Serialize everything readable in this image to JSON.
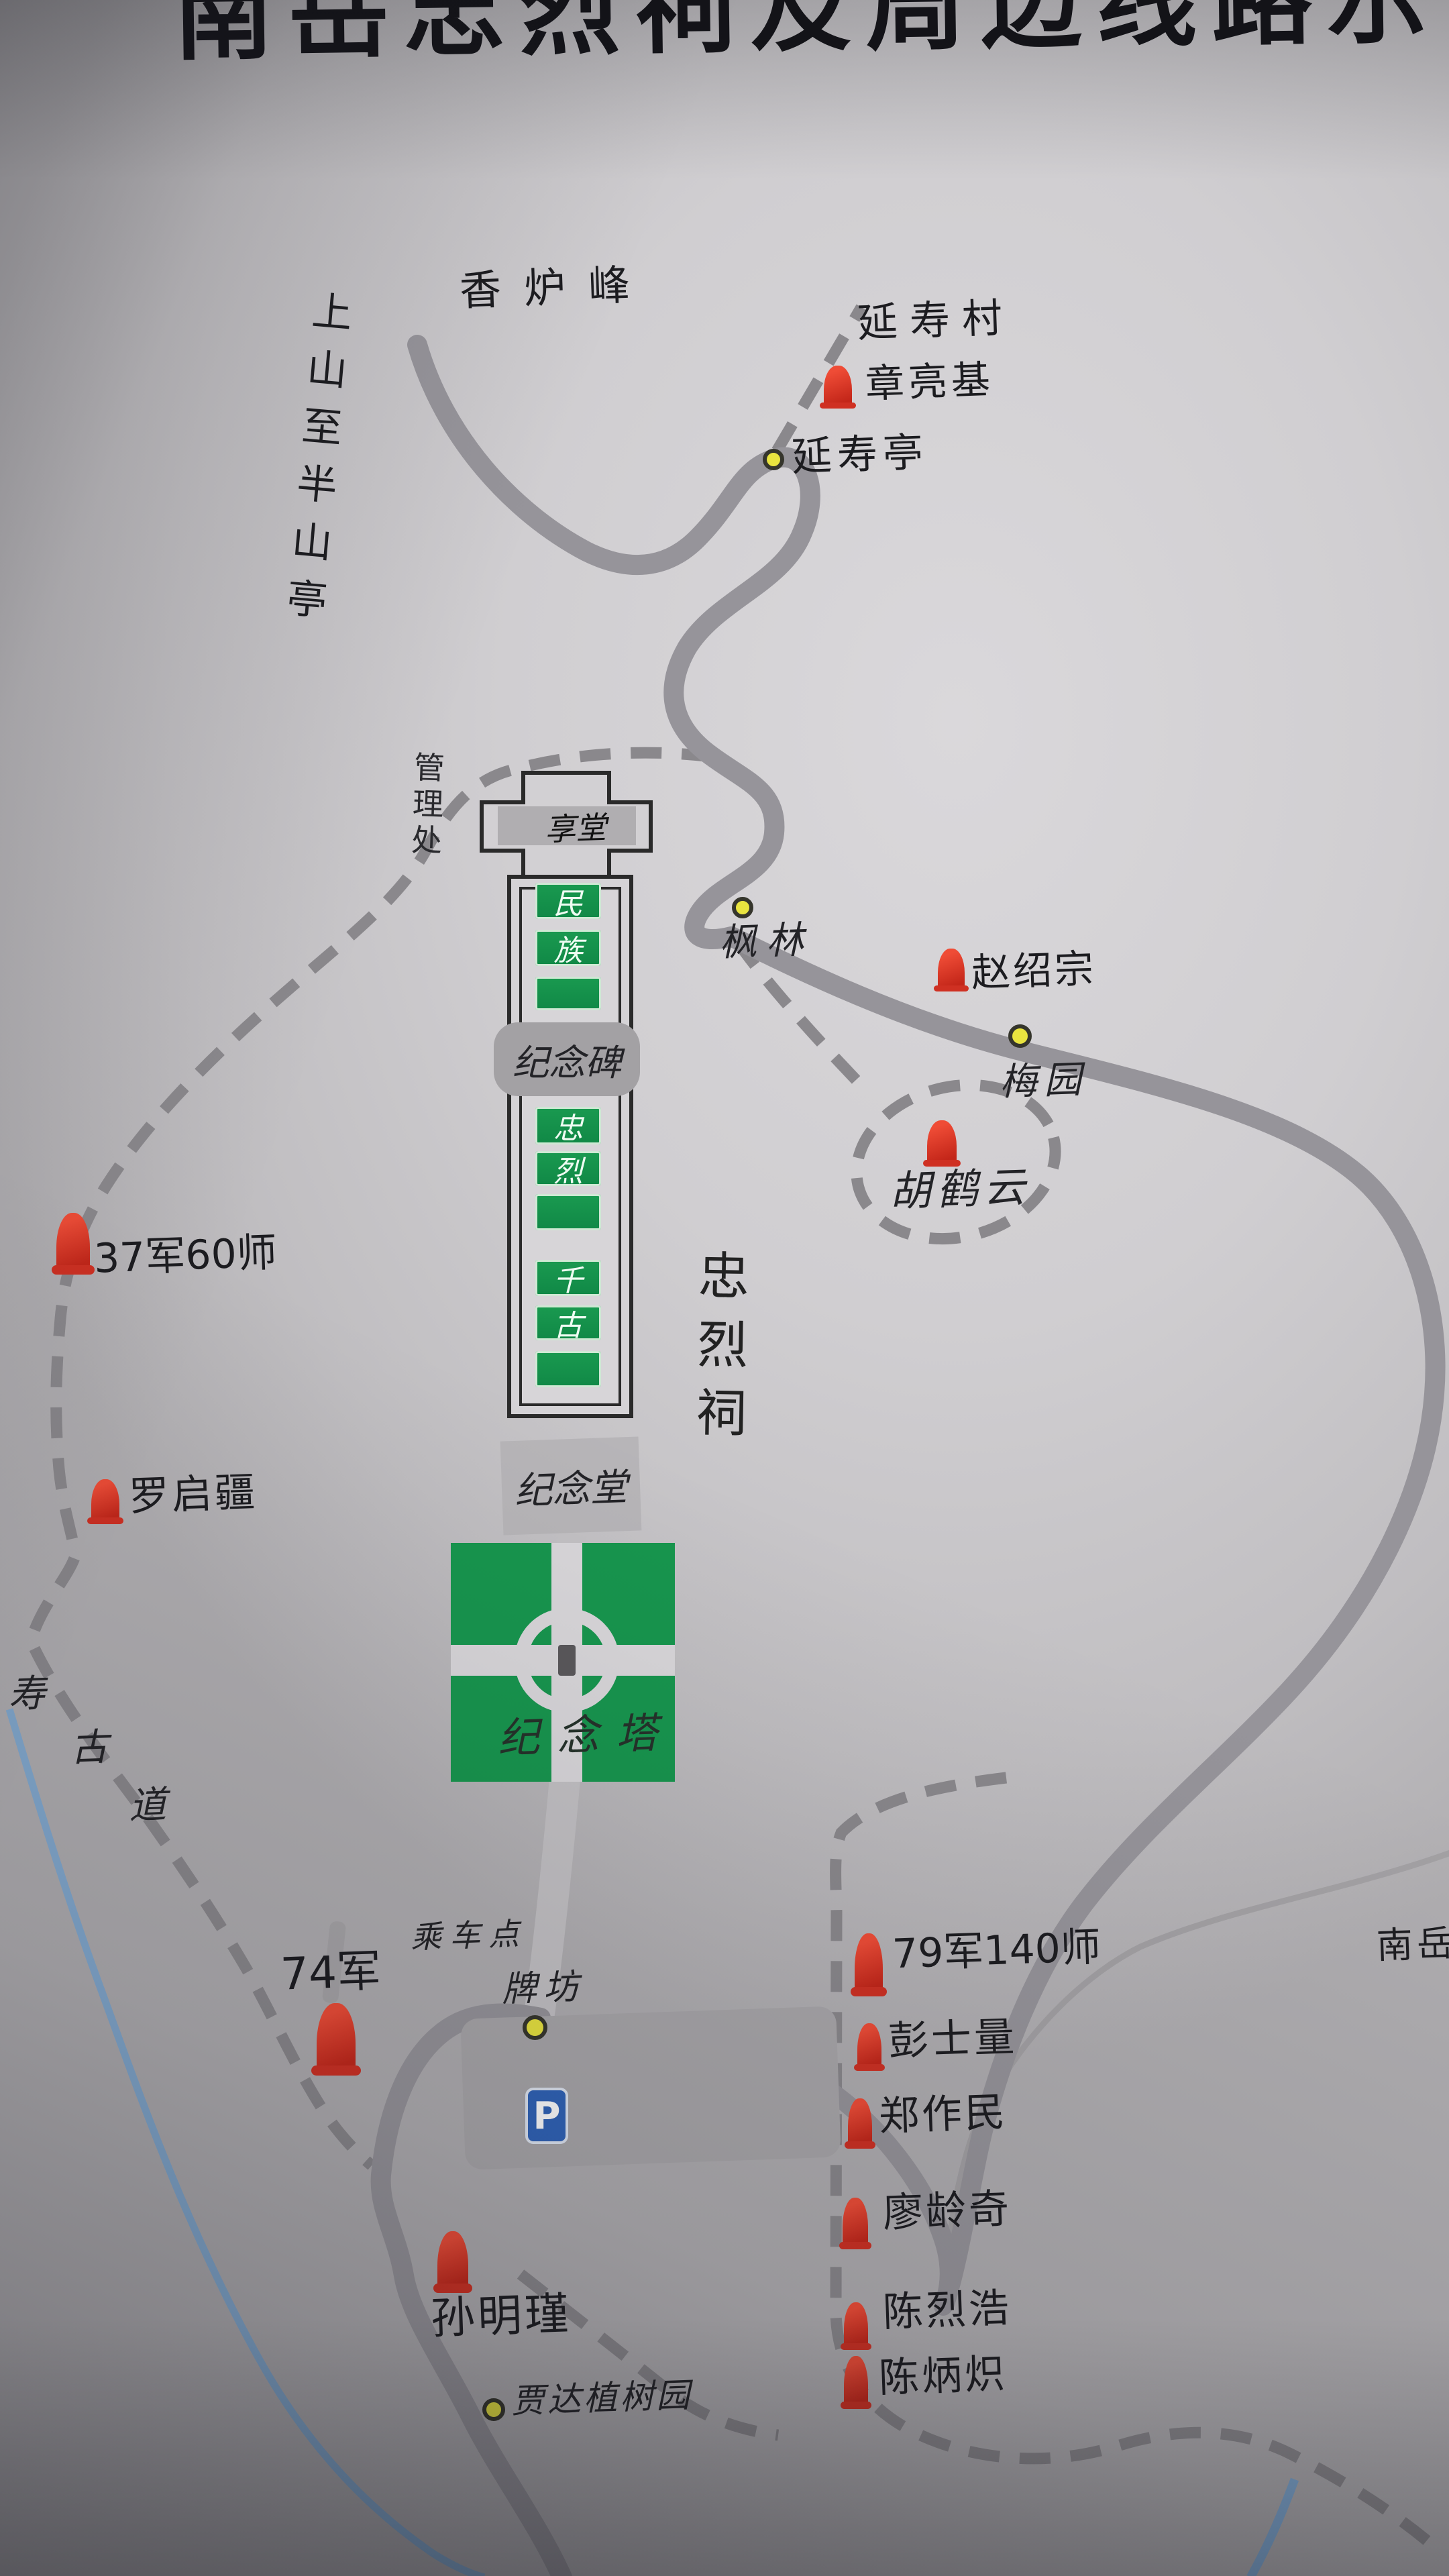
{
  "title": "南岳忠烈祠及周边线路示",
  "labels": {
    "peak": "香炉峰",
    "uphill_trail": "上山至半山亭",
    "village": "延寿村",
    "management_office": "管理处",
    "shrine_name": "忠烈祠",
    "ancient_trail": [
      "寿",
      "古",
      "道"
    ],
    "region_edge": "南岳",
    "boarding_point": "乘车点",
    "parking": "P"
  },
  "stations": [
    {
      "name": "延寿亭"
    },
    {
      "name": "枫林"
    },
    {
      "name": "梅园"
    },
    {
      "name": "牌坊"
    },
    {
      "name": "贾达植树园"
    }
  ],
  "shrine": {
    "xiangtang": "享堂",
    "stele": "纪念碑",
    "memorial_hall": "纪念堂",
    "memorial_tower": "纪念塔",
    "step_blocks": [
      "民",
      "族",
      "",
      "忠",
      "烈",
      "",
      "千",
      "古",
      ""
    ]
  },
  "memorials": [
    {
      "name": "章亮基"
    },
    {
      "name": "赵绍宗"
    },
    {
      "name": "胡鹤云"
    },
    {
      "name": "37军60师"
    },
    {
      "name": "罗启疆"
    },
    {
      "name": "74军"
    },
    {
      "name": "79军140师"
    },
    {
      "name": "彭士量"
    },
    {
      "name": "郑作民"
    },
    {
      "name": "廖龄奇"
    },
    {
      "name": "陈烈浩"
    },
    {
      "name": "陈炳炽"
    },
    {
      "name": "孙明瑾"
    }
  ],
  "colors": {
    "road": "#96949a",
    "trail": "#8a888c",
    "green": "#17964e",
    "marker_red": "#d93425",
    "dot_yellow": "#e9e43f",
    "stream_blue": "#7ba9d6",
    "parking_blue": "#2f63b8"
  }
}
